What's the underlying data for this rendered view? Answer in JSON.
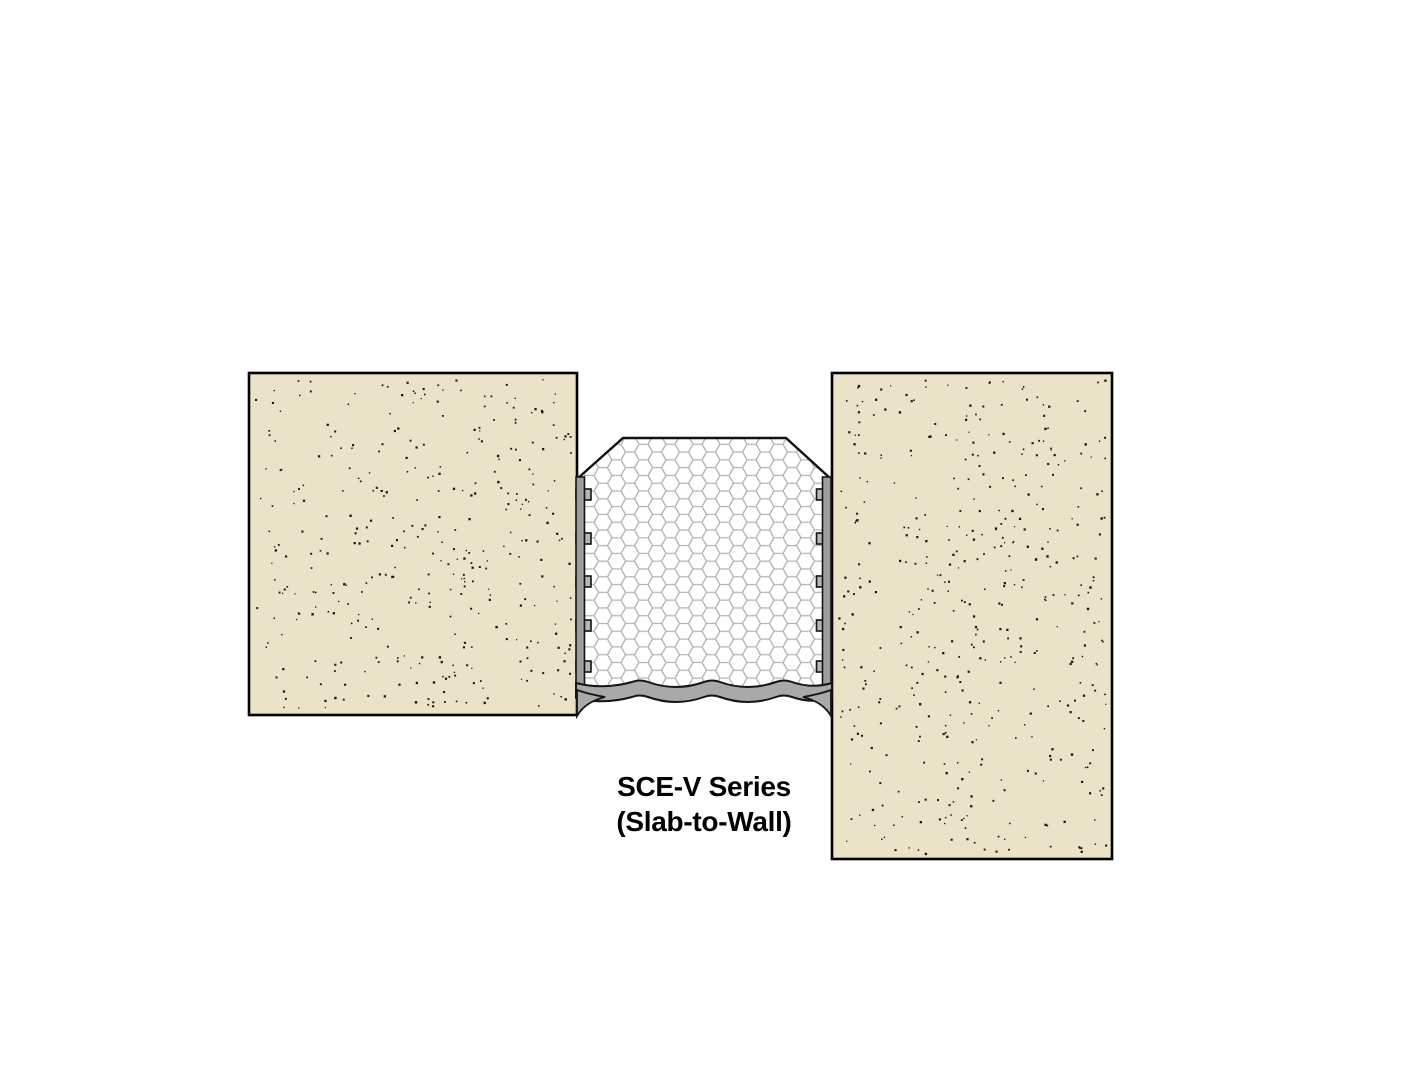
{
  "caption": {
    "line1": "SCE-V Series",
    "line2": "(Slab-to-Wall)"
  },
  "colors": {
    "background": "#ffffff",
    "concrete_fill": "#EAE3C7",
    "concrete_outline": "#000000",
    "concrete_speckle": "#181818",
    "foam_fill": "#ffffff",
    "foam_cell_line": "#b2b2b2",
    "foam_outline": "#111111",
    "rail_gray": "#9c9c9c",
    "tab_gray": "#b6b6b6",
    "sealant_gray": "#a9a9a9",
    "sealant_outline": "#141414",
    "text_color": "#000000"
  }
}
